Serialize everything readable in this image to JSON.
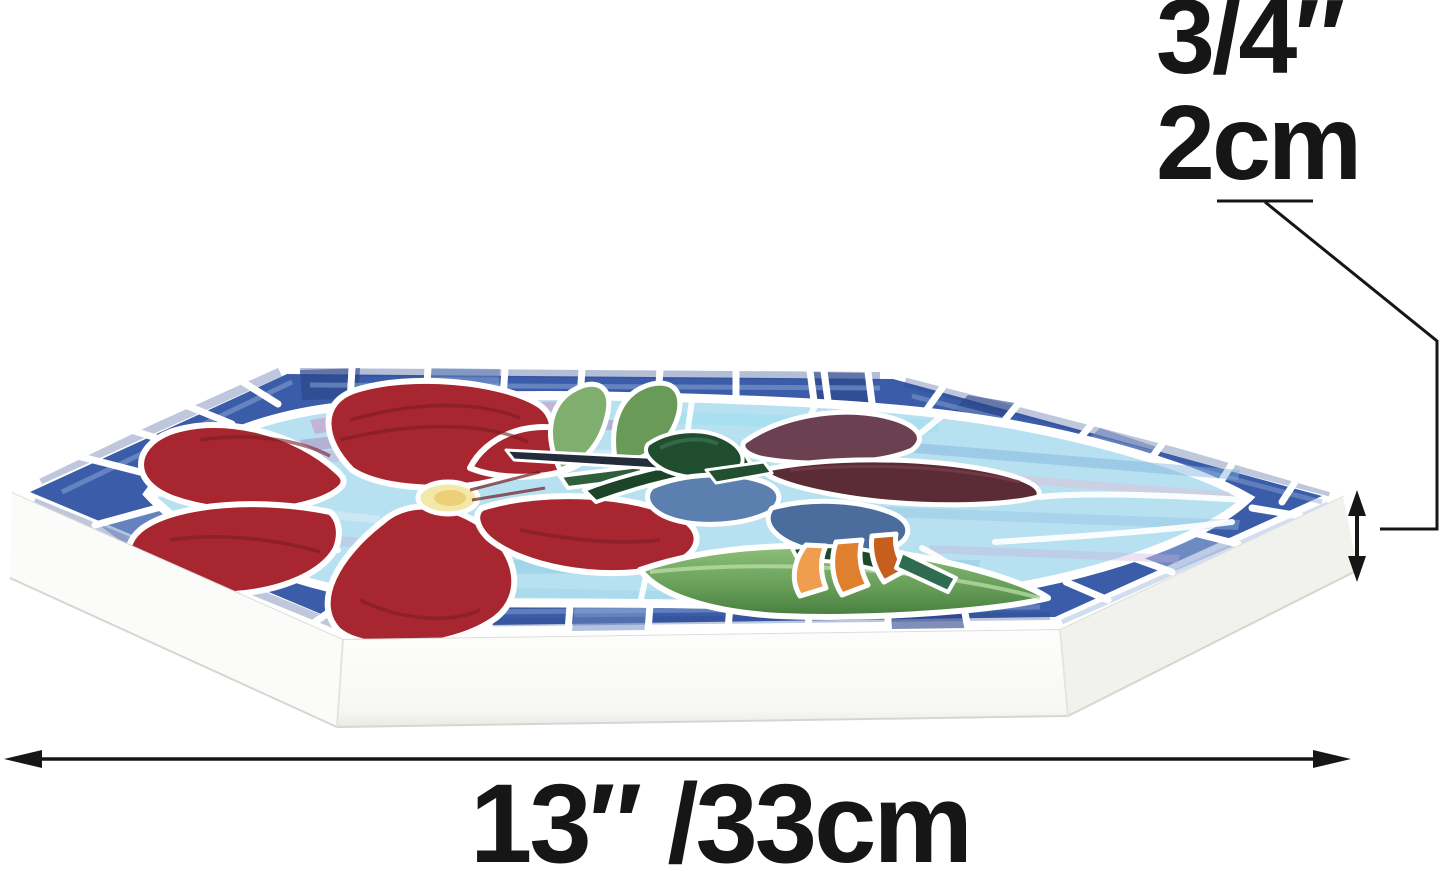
{
  "annotations": {
    "thickness_inches": "3/4″",
    "thickness_cm": "2cm",
    "width": "13″ /33cm"
  },
  "subject": "Hexagonal stained glass mosaic stepping stone with red hibiscus flower and hummingbird",
  "palette": {
    "ink": "#161616",
    "grout": "#ffffff",
    "stone-white": "#fbfbfa",
    "stone-shade": "#f1f1ee",
    "border-blue": "#3b5ca8",
    "border-blue-dark": "#2a4487",
    "border-blue-light": "#7e9bcd",
    "bg-blue": "#b7e0f0",
    "bg-streak-lavender": "#c9aed9",
    "bg-streak-pink": "#e5bcd0",
    "flower-red": "#a8262f",
    "flower-red-dark": "#7c1c26",
    "flower-center-yellow": "#f4e8a8",
    "leaf-green": "#7fae6e",
    "leaf-green-dark": "#4f8a48",
    "forest-green": "#1f4d2e",
    "bird-slate": "#5b7fae",
    "bird-slate-dark": "#4a6d9d",
    "wing-plum": "#6b4152",
    "wing-maroon": "#5c2c36",
    "tail-orange": "#e0802f",
    "tail-orange-light": "#ef9d4f",
    "tail-orange-dark": "#c65f1e"
  }
}
